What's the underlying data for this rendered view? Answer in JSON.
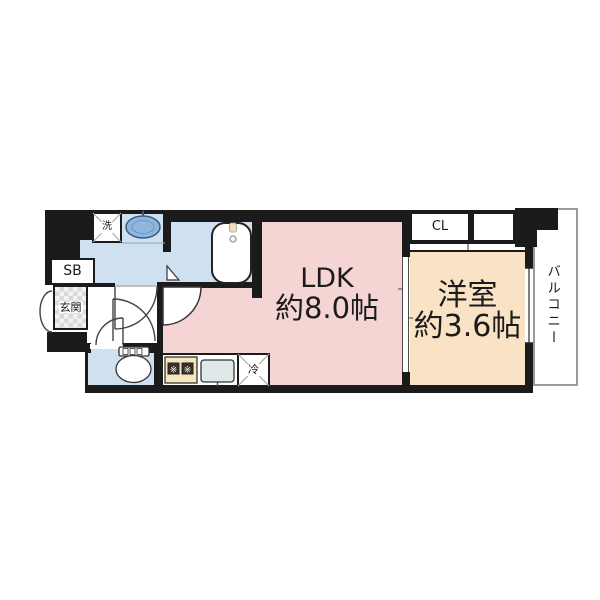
{
  "floorplan": {
    "labels": {
      "ldk": "LDK",
      "ldk_size": "約8.0帖",
      "western": "洋室",
      "western_size": "約3.6帖",
      "entrance": "玄関",
      "shoe_box": "SB",
      "closet": "CL",
      "balcony": "バルコニー",
      "washer": "洗",
      "fridge": "冷",
      "burner": "※"
    },
    "colors": {
      "wall": "#1b1b1b",
      "ldk_fill": "#f5d4d4",
      "western_fill": "#fae3c5",
      "wet_area_fill": "#cfe0f1",
      "basin_fill": "#8fb7de",
      "stove_fill": "#f7e5c0",
      "kitchen_sink_fill": "#dfe9e9",
      "balcony_border": "#9a9a9a"
    }
  }
}
